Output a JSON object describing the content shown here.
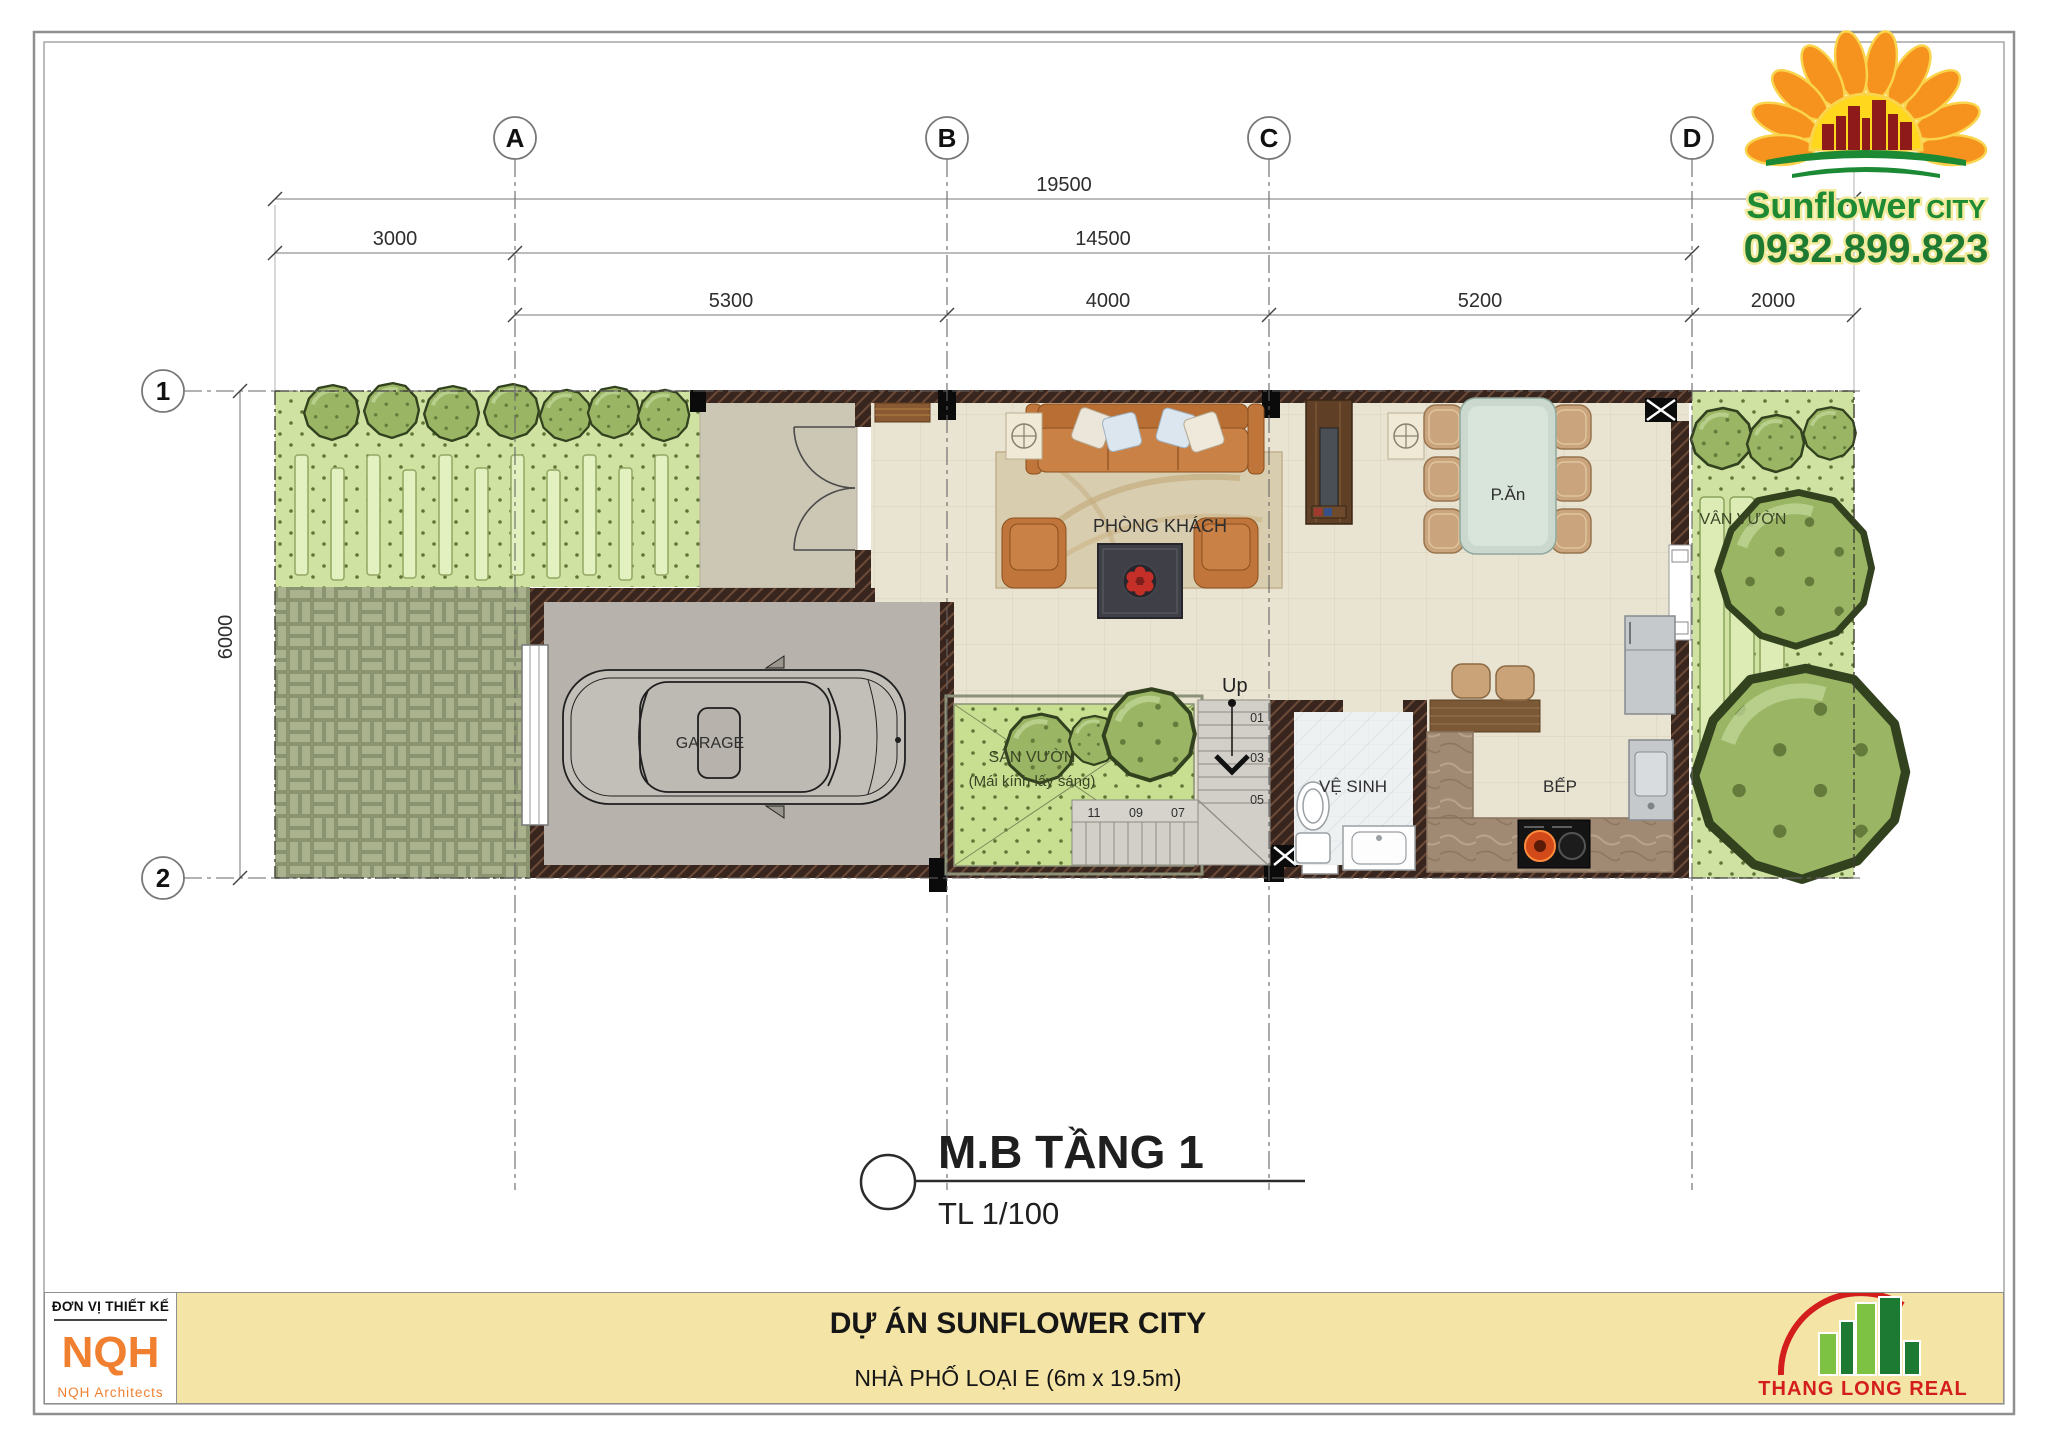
{
  "logo": {
    "brand": "Sunflower",
    "brand_suffix": "CITY",
    "phone": "0932.899.823"
  },
  "grid": {
    "col_a": "A",
    "col_b": "B",
    "col_c": "C",
    "col_d": "D",
    "row_1": "1",
    "row_2": "2"
  },
  "dims": {
    "total": "19500",
    "left": "3000",
    "mid": "14500",
    "seg_ab": "5300",
    "seg_bc": "4000",
    "seg_cd": "5200",
    "seg_d_end": "2000",
    "depth": "6000"
  },
  "rooms": {
    "garage": "GARAGE",
    "living": "PHÒNG KHÁCH",
    "dining": "P.Ăn",
    "bath": "VỆ SINH",
    "kitchen": "BẾP",
    "courtyard": "SÂN VƯỜN",
    "courtyard_note": "(Mái kính lấy sáng)",
    "side_garden": "VÂN VƯỜN"
  },
  "stairs": {
    "up": "Up",
    "n01": "01",
    "n03": "03",
    "n05": "05",
    "n07": "07",
    "n09": "09",
    "n11": "11"
  },
  "title": {
    "main": "M.B TẦNG 1",
    "scale": "TL 1/100"
  },
  "titleblock": {
    "designer_label": "ĐƠN VỊ THIẾT KẾ",
    "designer": "NQH",
    "designer_sub": "NQH Architects",
    "project": "DỰ ÁN SUNFLOWER CITY",
    "type": "NHÀ PHỐ LOẠI E (6m x 19.5m)",
    "developer": "THANG LONG REAL"
  },
  "colors": {
    "accent_orange": "#f08030",
    "bar_yellow": "#f4e4a6",
    "brand_green": "#1e8a34",
    "developer_red": "#d41e1e",
    "wall": "#38251e",
    "garden": "#cfe2a2",
    "paving": "#a9b28c"
  }
}
